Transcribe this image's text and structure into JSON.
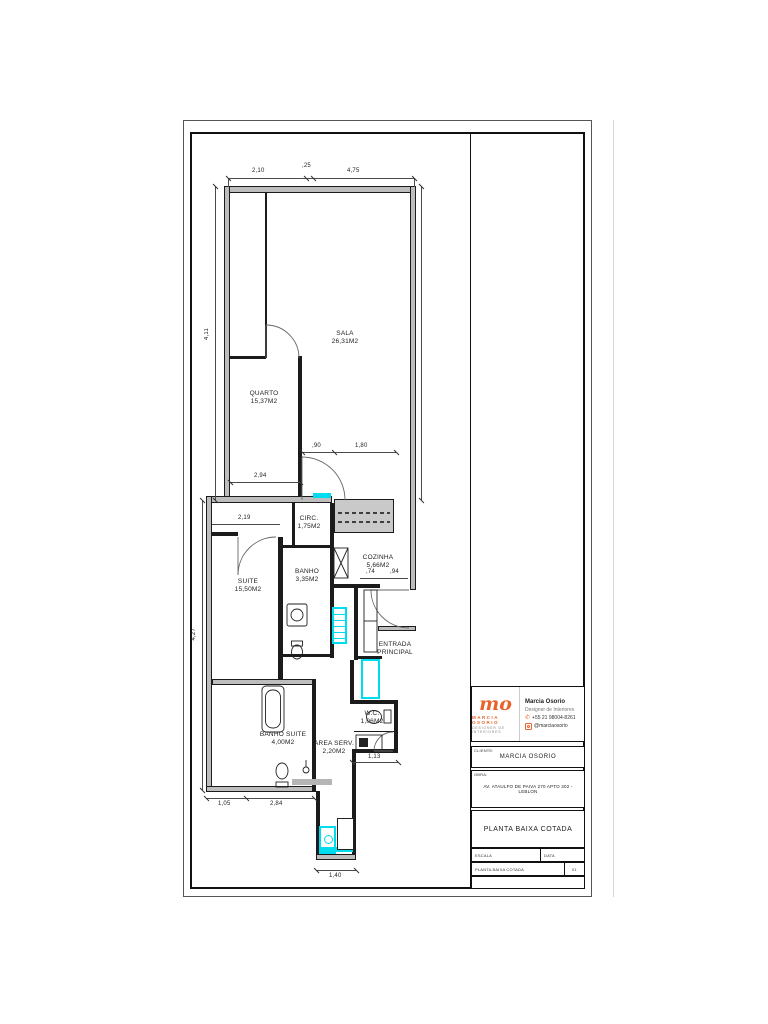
{
  "colors": {
    "highlight": "#00DCEF",
    "accent": "#E8632C",
    "wall_fill": "#BDBDBD"
  },
  "rooms": {
    "sala": {
      "name": "SALA",
      "area": "26,31M2"
    },
    "quarto": {
      "name": "QUARTO",
      "area": "15,37M2"
    },
    "circ": {
      "name": "CIRC.",
      "area": "1,75M2"
    },
    "suite": {
      "name": "SUITE",
      "area": "15,50M2"
    },
    "banho": {
      "name": "BANHO",
      "area": "3,35M2"
    },
    "cozinha": {
      "name": "COZINHA",
      "area": "5,66M2"
    },
    "banho_suite": {
      "name": "BANHO SUITE",
      "area": "4,00M2"
    },
    "area_serv": {
      "name": "AREA SERV.",
      "area": "2,20M2"
    },
    "wc": {
      "name": "W.C.",
      "area": "1,06M2"
    },
    "entrada": {
      "line1": "ENTRADA",
      "line2": "PRINCIPAL"
    }
  },
  "dims": {
    "top_left": "2,10",
    "top_mid": ",25",
    "top_right": "4,75",
    "left_upper": "4,11",
    "left_lower": "4,27",
    "quarto_width": "2,94",
    "suite_top": "2,19",
    "circ_door": ",90",
    "counter": "1,80",
    "entr_a": ",74",
    "entr_b": ",94",
    "wc_width": "1,13",
    "bs_left": "1,05",
    "bs_right": "2,84",
    "ext_width": "1,40"
  },
  "titleblock": {
    "logo": {
      "mark": "mo",
      "brand": "MARCIA OSORIO",
      "sub": "DESIGNER DE INTERIORES"
    },
    "contact": {
      "name": "Marcia Osorio",
      "role": "Designer de Interiores",
      "phone": "+55 21 98004-8261",
      "instagram": "@marciaosorio"
    },
    "client_label": "CLIENTE:",
    "client": "MARCIA OSORIO",
    "obra_label": "OBRA:",
    "obra": "AV. ATAULFO DE PAIVA 270 APTO 302 - LEBLON",
    "drawing_title": "PLANTA BAIXA COTADA",
    "fields": {
      "escala_label": "ESCALA",
      "data_label": "DATA",
      "folha_left": "PLANTA BAIXA COTADA",
      "folha_value": "01"
    }
  }
}
